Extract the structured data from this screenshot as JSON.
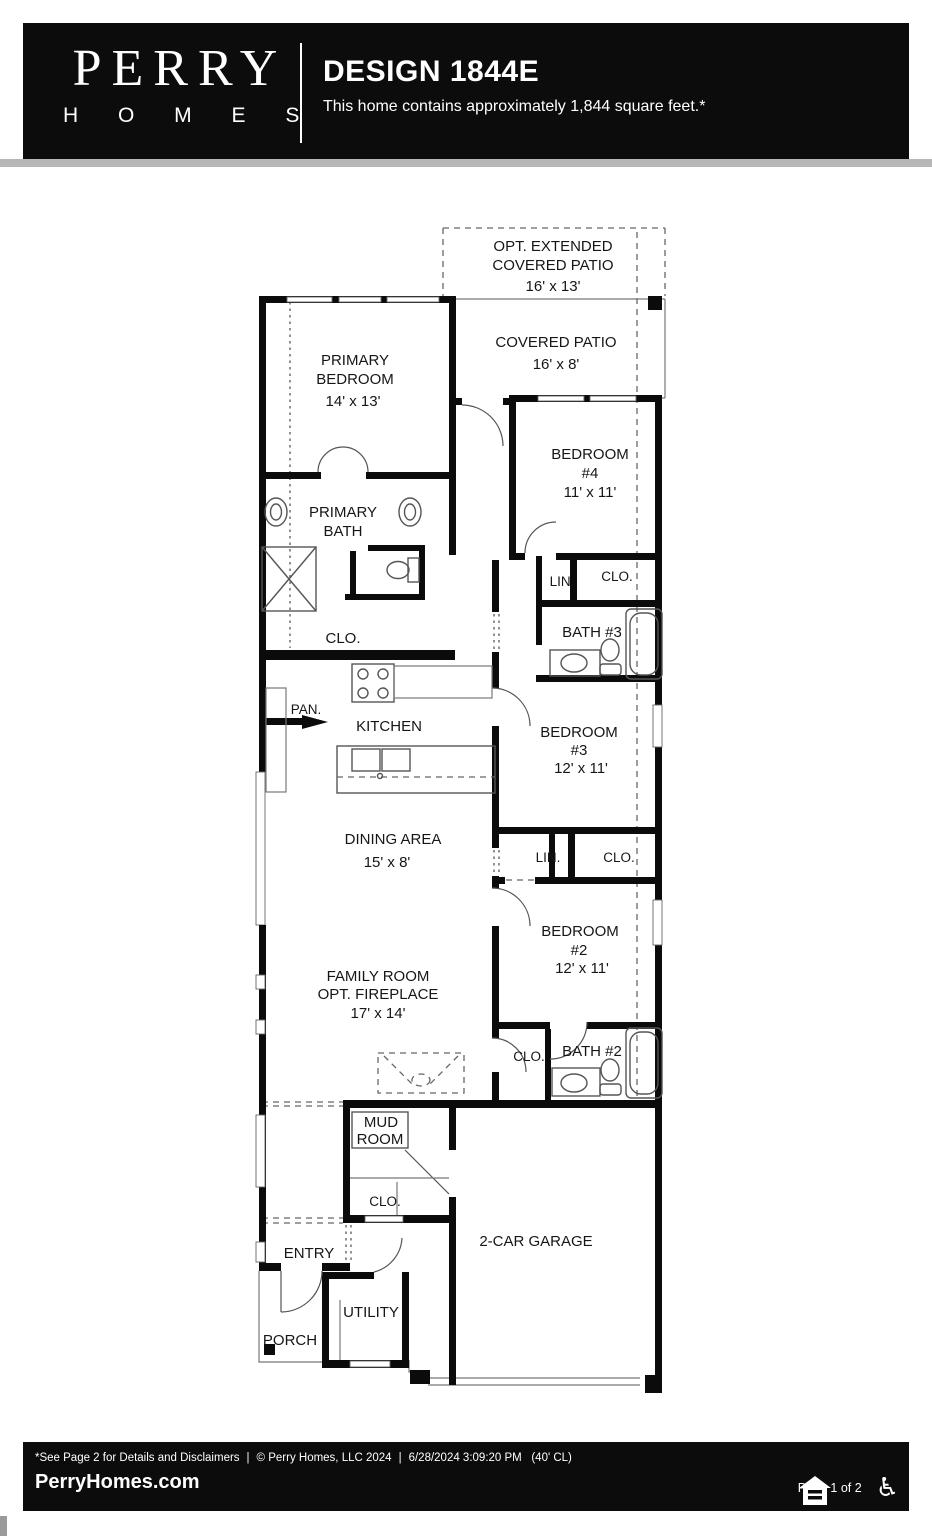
{
  "header": {
    "brand_top": "PERRY",
    "brand_bottom": "H O M E S",
    "title": "DESIGN 1844E",
    "subtitle": "This home contains approximately 1,844 square feet.*"
  },
  "plan": {
    "opt_patio": {
      "line1": "OPT. EXTENDED",
      "line2": "COVERED PATIO",
      "dims": "16' x 13'"
    },
    "covered_patio": {
      "line1": "COVERED PATIO",
      "dims": "16' x 8'"
    },
    "primary_bedroom": {
      "line1": "PRIMARY",
      "line2": "BEDROOM",
      "dims": "14' x 13'"
    },
    "bedroom4": {
      "line1": "BEDROOM",
      "line2": "#4",
      "dims": "11' x 11'"
    },
    "primary_bath": {
      "line1": "PRIMARY",
      "line2": "BATH"
    },
    "primary_closet": {
      "label": "CLO."
    },
    "linen1": {
      "label": "LIN."
    },
    "closet1": {
      "label": "CLO."
    },
    "bath3": {
      "label": "BATH #3"
    },
    "pantry": {
      "label": "PAN."
    },
    "kitchen": {
      "label": "KITCHEN"
    },
    "bedroom3": {
      "line1": "BEDROOM",
      "line2": "#3",
      "dims": "12' x 11'"
    },
    "dining": {
      "line1": "DINING AREA",
      "dims": "15' x 8'"
    },
    "linen2": {
      "label": "LIN."
    },
    "closet2": {
      "label": "CLO."
    },
    "bedroom2": {
      "line1": "BEDROOM",
      "line2": "#2",
      "dims": "12' x 11'"
    },
    "family_room": {
      "line1": "FAMILY ROOM",
      "line2": "OPT. FIREPLACE",
      "dims": "17' x 14'"
    },
    "closet3": {
      "label": "CLO."
    },
    "bath2": {
      "label": "BATH #2"
    },
    "mud_room": {
      "line1": "MUD",
      "line2": "ROOM"
    },
    "closet4": {
      "label": "CLO."
    },
    "garage": {
      "label": "2-CAR GARAGE"
    },
    "entry": {
      "label": "ENTRY"
    },
    "utility": {
      "label": "UTILITY"
    },
    "porch": {
      "label": "PORCH"
    }
  },
  "footer": {
    "disclaimer": "*See Page 2 for Details and Disclaimers",
    "sep": "|",
    "copyright": "© Perry Homes, LLC 2024",
    "timestamp": "6/28/2024 3:09:20 PM",
    "lot": "(40' CL)",
    "website": "PerryHomes.com",
    "page": "Page 1 of 2"
  }
}
